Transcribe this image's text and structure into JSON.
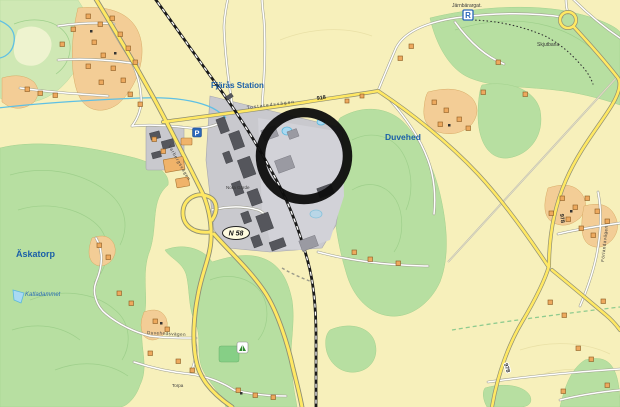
{
  "map": {
    "place_labels": {
      "station": "Fjärås Station",
      "duvehed": "Duvehed",
      "askatorp": "Äskatorp",
      "katladammet": "Katladammet",
      "skjutbana": "Skjutbana",
      "jarnbarargat": "Järnbärargat.",
      "torpa": "Torpa",
      "nora_garde": "Nora Gärde"
    },
    "street_labels": {
      "tostaredsvagen": "Tostaredsvägen",
      "varbergsvagen": "Varbergsvägen",
      "duvehedsvagen": "Duvehedsvägen",
      "forlandavagen": "Förlandavägen"
    },
    "road_numbers": {
      "n918": "918",
      "n978_upper": "978",
      "n978_lower": "978",
      "n58": "N 58"
    },
    "badges": {
      "parking": "P",
      "rest_area": "R"
    },
    "colors": {
      "background": "#f7f0bb",
      "forest_green": "#b7dfa1",
      "road_yellow": "#ffe863",
      "water_blue": "#a9d9f2",
      "place_label_blue": "#1a5fa8",
      "industrial_gray": "#c9c9ce",
      "building_dark_gray": "#55565c",
      "house_orange": "#eda95e",
      "annotation_circle": "#0d0d0d"
    }
  }
}
